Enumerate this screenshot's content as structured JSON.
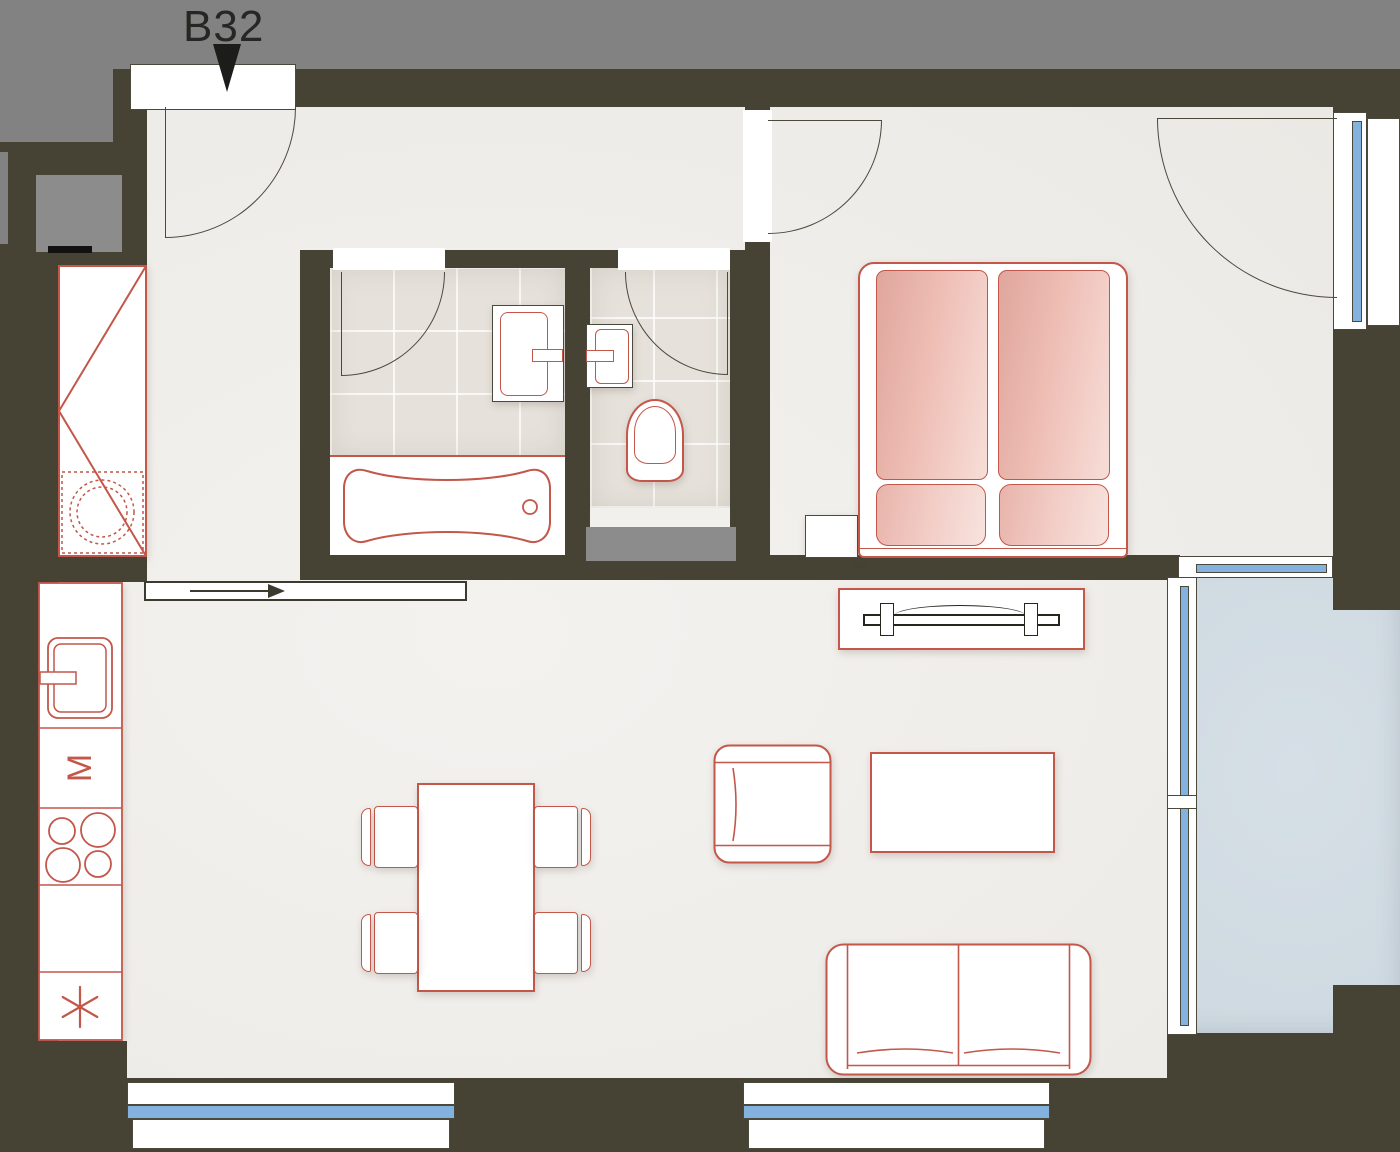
{
  "unit": {
    "label": "B32"
  },
  "symbols": {
    "kitchen_appliance_letter": "M",
    "freezer_star": "six-spoke-asterisk",
    "entrance_marker": "filled-triangle-down",
    "sliding_door_arrow": "arrow-right"
  },
  "colors": {
    "wall": "#464334",
    "corridor": "#828282",
    "floor": "#f0eeeb",
    "bathroom_tile": "#e6e2db",
    "furniture_outline": "#c2574a",
    "bed_textile_dark": "#dfa69c",
    "bed_textile_light": "#f7ded8",
    "window_glass": "#83b2de",
    "balcony_floor": "#ccd7df",
    "duct_shaft": "#8c8c8c",
    "door_line": "#4b493c"
  }
}
